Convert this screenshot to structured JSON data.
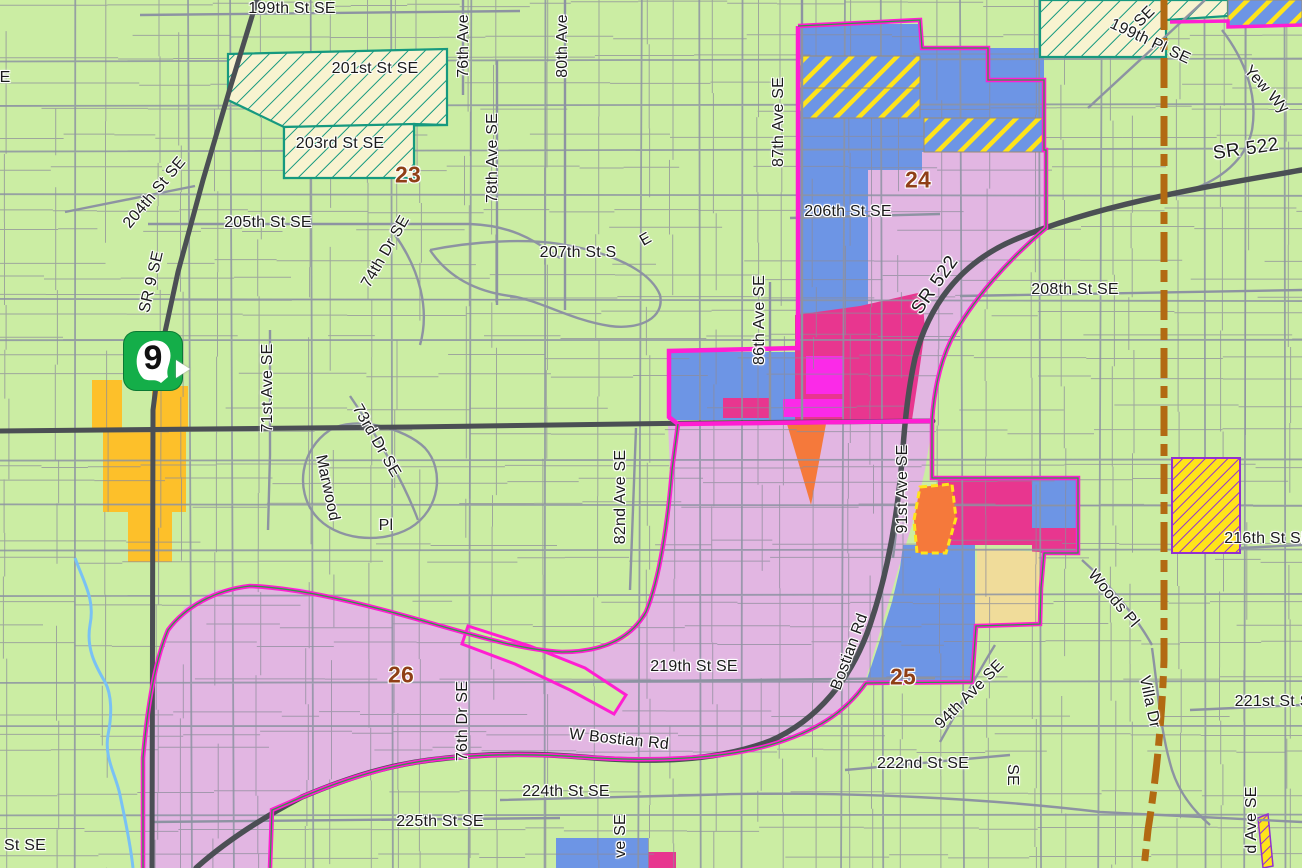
{
  "map": {
    "title": "zoning-parcel-map",
    "route_shield": {
      "number": "9"
    },
    "colors": {
      "background": "#cbeda3",
      "parcel-line": "#8c8c9a",
      "road-major": "#4b4f54",
      "road-minor": "#8d93a2",
      "city-boundary": "#ff1ed2",
      "boundary-inner": "#2f9c45",
      "uga-line": "#b26a12",
      "creek": "#79c1f4",
      "zone-pink": "#e2b6e2",
      "zone-blue": "#6d95e5",
      "zone-deeppink": "#e8368f",
      "zone-magenta": "#fb2ae8",
      "zone-orange": "#f5793b",
      "zone-tan": "#f0dc9a",
      "zone-yellow": "#fdc02a",
      "hatch-cream": "#f8f3d0",
      "hatch-teal": "#16997f",
      "hatch-yellow": "#ffe41a",
      "hatch-purple": "#9231d1",
      "label": "#1b1b1b",
      "district": "#8f3f16",
      "shield": "#14ae49"
    },
    "district_labels": [
      {
        "text": "23",
        "x": 408,
        "y": 175
      },
      {
        "text": "24",
        "x": 918,
        "y": 180
      },
      {
        "text": "25",
        "x": 903,
        "y": 677
      },
      {
        "text": "26",
        "x": 401,
        "y": 675
      }
    ],
    "street_labels": [
      {
        "text": "199th St SE",
        "x": 292,
        "y": 9
      },
      {
        "text": "201st St SE",
        "x": 375,
        "y": 69
      },
      {
        "text": "203rd St SE",
        "x": 340,
        "y": 144
      },
      {
        "text": "204th St SE",
        "x": 155,
        "y": 193,
        "rot": -50
      },
      {
        "text": "SR 9 SE",
        "x": 152,
        "y": 282,
        "rot": -77
      },
      {
        "text": "205th St SE",
        "x": 268,
        "y": 223
      },
      {
        "text": "74th Dr SE",
        "x": 386,
        "y": 252,
        "rot": -60
      },
      {
        "text": "78th Ave SE",
        "x": 493,
        "y": 158,
        "rot": -90
      },
      {
        "text": "76th Ave",
        "x": 464,
        "y": 46,
        "rot": -90
      },
      {
        "text": "80th Ave",
        "x": 563,
        "y": 46,
        "rot": -90
      },
      {
        "text": "87th Ave SE",
        "x": 779,
        "y": 122,
        "rot": -90
      },
      {
        "text": "206th St SE",
        "x": 848,
        "y": 212
      },
      {
        "text": "207th St S",
        "x": 578,
        "y": 253
      },
      {
        "text": "E",
        "x": 646,
        "y": 240,
        "rot": -30
      },
      {
        "text": "208th St SE",
        "x": 1075,
        "y": 290
      },
      {
        "text": "SR 522",
        "x": 935,
        "y": 285,
        "rot": -55,
        "hw": true
      },
      {
        "text": "SR 522",
        "x": 1246,
        "y": 149,
        "rot": -8,
        "hw": true
      },
      {
        "text": "199th Pl SE",
        "x": 1150,
        "y": 42,
        "rot": 25
      },
      {
        "text": "SE",
        "x": 1145,
        "y": 17,
        "rot": -45
      },
      {
        "text": "Yew Wy",
        "x": 1266,
        "y": 90,
        "rot": 48
      },
      {
        "text": "E",
        "x": 5,
        "y": 78
      },
      {
        "text": "71st Ave SE",
        "x": 268,
        "y": 388,
        "rot": -90
      },
      {
        "text": "73rd Dr SE",
        "x": 376,
        "y": 441,
        "rot": 60
      },
      {
        "text": "Marwood",
        "x": 327,
        "y": 488,
        "rot": 78
      },
      {
        "text": "Pl",
        "x": 386,
        "y": 526
      },
      {
        "text": "82nd Ave SE",
        "x": 621,
        "y": 497,
        "rot": -90
      },
      {
        "text": "86th Ave SE",
        "x": 760,
        "y": 320,
        "rot": -90
      },
      {
        "text": "91st Ave SE",
        "x": 903,
        "y": 489,
        "rot": -90
      },
      {
        "text": "Bostian Rd",
        "x": 850,
        "y": 652,
        "rot": -70
      },
      {
        "text": "94th Ave SE",
        "x": 970,
        "y": 695,
        "rot": -45
      },
      {
        "text": "219th St SE",
        "x": 694,
        "y": 667
      },
      {
        "text": "76th Dr SE",
        "x": 463,
        "y": 721,
        "rot": -90
      },
      {
        "text": "W Bostian Rd",
        "x": 619,
        "y": 740,
        "rot": 6
      },
      {
        "text": "224th St SE",
        "x": 566,
        "y": 792
      },
      {
        "text": "225th St SE",
        "x": 440,
        "y": 822
      },
      {
        "text": "222nd St SE",
        "x": 923,
        "y": 764
      },
      {
        "text": "SE",
        "x": 1012,
        "y": 775,
        "rot": 90
      },
      {
        "text": "ve SE",
        "x": 621,
        "y": 836,
        "rot": -90
      },
      {
        "text": "216th St SE",
        "x": 1268,
        "y": 539
      },
      {
        "text": "221st St SE",
        "x": 1278,
        "y": 702
      },
      {
        "text": "d Ave SE",
        "x": 1252,
        "y": 820,
        "rot": -90
      },
      {
        "text": "St SE",
        "x": 25,
        "y": 846
      },
      {
        "text": "Woods Pl",
        "x": 1113,
        "y": 599,
        "rot": 50
      },
      {
        "text": "Villa Dr",
        "x": 1149,
        "y": 702,
        "rot": 78
      }
    ]
  }
}
